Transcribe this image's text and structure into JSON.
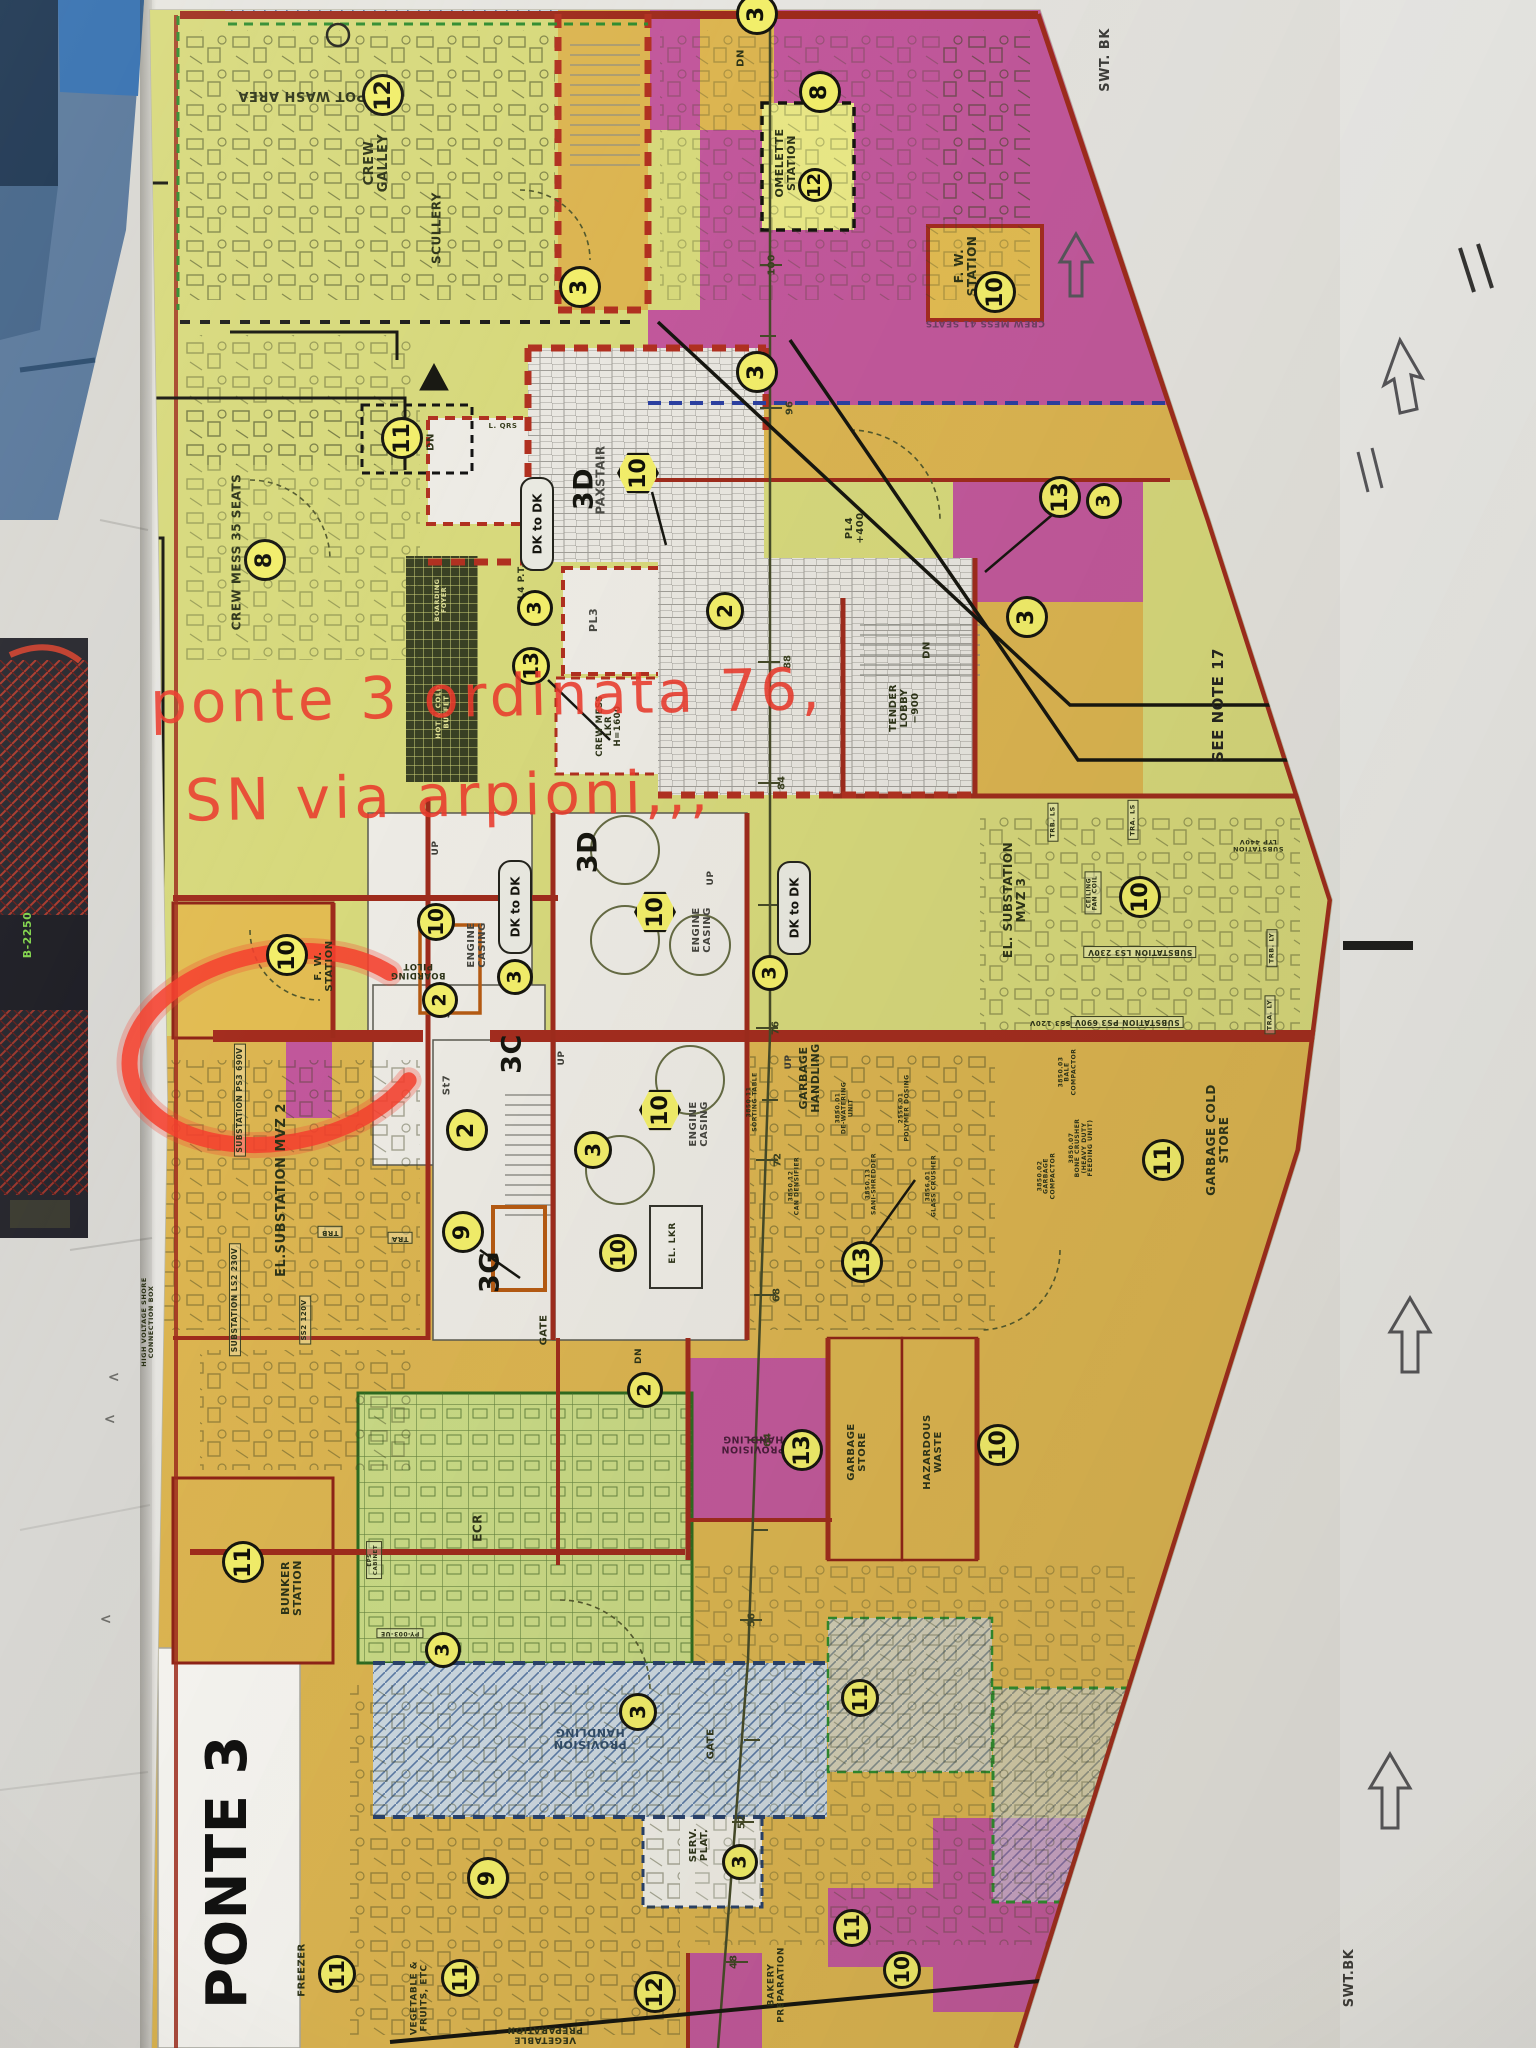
{
  "annotation": {
    "line1": "ponte 3 ordinata 76,",
    "line2": "SN  via arpioni,,,",
    "color": "#ea3a2c"
  },
  "colors": {
    "plan_yellow_green": "#d7d97c",
    "plan_gold": "#dcb551",
    "plan_magenta": "#c2589c",
    "wall_red": "#a32c1e",
    "badge_yellow": "#f2ee6a",
    "marker_red": "#f4402e",
    "hatch_blue": "#5577aa"
  },
  "plan": {
    "dk_pill_label": "DK to DK",
    "deck_title": "PONTE 3",
    "labels": [
      {
        "id": "pot-wash-area-label",
        "t": "POT WASH AREA",
        "x": 302,
        "y": 95,
        "rot": 180,
        "fs": 13
      },
      {
        "id": "crew-galley-label",
        "t": "CREW\nGALLEY",
        "x": 377,
        "y": 163,
        "rot": -90,
        "fs": 13
      },
      {
        "id": "scullery-label",
        "t": "SCULLERY",
        "x": 437,
        "y": 228,
        "rot": -90,
        "fs": 12
      },
      {
        "id": "omelette-station-label",
        "t": "OMELETTE\nSTATION",
        "x": 786,
        "y": 163,
        "rot": -90,
        "fs": 11
      },
      {
        "id": "fw-station-1-label",
        "t": "F. W.\nSTATION",
        "x": 966,
        "y": 266,
        "rot": -90,
        "fs": 12
      },
      {
        "id": "crew-mess-41-label",
        "t": "CREW MESS 41 SEATS",
        "x": 985,
        "y": 322,
        "rot": 180,
        "fs": 9,
        "c": "#6e3d63"
      },
      {
        "id": "dn-top-label",
        "t": "DN",
        "x": 742,
        "y": 58,
        "rot": -90,
        "fs": 10
      },
      {
        "id": "lqrs-label",
        "t": "L. QRS",
        "x": 503,
        "y": 427,
        "rot": 0,
        "fs": 7,
        "c": "#3a4020"
      },
      {
        "id": "dn-11-label",
        "t": "DN",
        "x": 432,
        "y": 442,
        "rot": -90,
        "fs": 10
      },
      {
        "id": "crew-mess-35-label",
        "t": "CREW MESS  35 SEATS",
        "x": 237,
        "y": 552,
        "rot": -90,
        "fs": 12
      },
      {
        "id": "hot-cold-buffet-label",
        "t": "HOT & COLD\nBUFFET",
        "x": 443,
        "y": 712,
        "rot": -90,
        "fs": 7,
        "c": "#e2e294"
      },
      {
        "id": "boarding-foyer-label",
        "t": "BOARDING\nFOYER",
        "x": 441,
        "y": 600,
        "rot": -90,
        "fs": 6.5,
        "c": "#dfe09a"
      },
      {
        "id": "paxstair-label",
        "t": "PAXSTAIR",
        "x": 601,
        "y": 480,
        "rot": -90,
        "fs": 12,
        "c": "#4a4a44"
      },
      {
        "id": "pl3-label",
        "t": "PL3",
        "x": 594,
        "y": 620,
        "rot": -90,
        "fs": 11,
        "c": "#4a4a44"
      },
      {
        "id": "pl4-pt-label",
        "t": "PL4 P.T.",
        "x": 523,
        "y": 585,
        "rot": -90,
        "fs": 9
      },
      {
        "id": "crew-mess-lkr-label",
        "t": "CREW MESS\nLKR\nH=1600",
        "x": 610,
        "y": 726,
        "rot": -90,
        "fs": 8.5
      },
      {
        "id": "pl4-400-label",
        "t": "PL4\n+400",
        "x": 856,
        "y": 528,
        "rot": -90,
        "fs": 10
      },
      {
        "id": "tender-lobby-label",
        "t": "TENDER\nLOBBY\n−900",
        "x": 905,
        "y": 708,
        "rot": -90,
        "fs": 10
      },
      {
        "id": "dn-tender-label",
        "t": "DN",
        "x": 928,
        "y": 650,
        "rot": -90,
        "fs": 10
      },
      {
        "id": "see-note-17-label",
        "t": "SEE NOTE 17",
        "x": 1218,
        "y": 705,
        "rot": -90,
        "fs": 15,
        "c": "#23231f",
        "w": 700
      },
      {
        "id": "swt-bk-top-label",
        "t": "SWT. BK",
        "x": 1106,
        "y": 60,
        "rot": -90,
        "fs": 13,
        "c": "#3c3c3a"
      },
      {
        "id": "swt-bk-bottom-label",
        "t": "SWT.BK",
        "x": 1350,
        "y": 1978,
        "rot": -90,
        "fs": 13,
        "c": "#3c3c3a"
      },
      {
        "id": "boarding-pilot-label",
        "t": "BOARDING\nPILOT",
        "x": 418,
        "y": 970,
        "rot": 180,
        "fs": 8.5
      },
      {
        "id": "fw-station-2-label",
        "t": "F. W.\nSTATION",
        "x": 325,
        "y": 966,
        "rot": -90,
        "fs": 10
      },
      {
        "id": "engine-casing-1-label",
        "t": "ENGINE\nCASING",
        "x": 478,
        "y": 945,
        "rot": -90,
        "fs": 10,
        "c": "#45453f"
      },
      {
        "id": "engine-casing-2-label",
        "t": "ENGINE\nCASING",
        "x": 703,
        "y": 930,
        "rot": -90,
        "fs": 10,
        "c": "#45453f"
      },
      {
        "id": "engine-casing-3-label",
        "t": "ENGINE\nCASING",
        "x": 700,
        "y": 1124,
        "rot": -90,
        "fs": 10,
        "c": "#45453f"
      },
      {
        "id": "st6-label",
        "t": "St6",
        "x": 448,
        "y": 1008,
        "rot": -90,
        "fs": 10,
        "c": "#45453f"
      },
      {
        "id": "st7-label",
        "t": "St7",
        "x": 448,
        "y": 1085,
        "rot": -90,
        "fs": 10,
        "c": "#45453f"
      },
      {
        "id": "up-1-label",
        "t": "UP",
        "x": 437,
        "y": 848,
        "rot": -90,
        "fs": 9,
        "c": "#3c3c36"
      },
      {
        "id": "up-2-label",
        "t": "UP",
        "x": 712,
        "y": 878,
        "rot": -90,
        "fs": 9,
        "c": "#3c3c36"
      },
      {
        "id": "up-3-label",
        "t": "UP",
        "x": 563,
        "y": 1058,
        "rot": -90,
        "fs": 9,
        "c": "#3c3c36"
      },
      {
        "id": "up-4-label",
        "t": "UP",
        "x": 790,
        "y": 1062,
        "rot": -90,
        "fs": 9,
        "c": "#3c3c36"
      },
      {
        "id": "el-substation-mvz2-label",
        "t": "EL.SUBSTATION MVZ 2",
        "x": 282,
        "y": 1190,
        "rot": -90,
        "fs": 13
      },
      {
        "id": "substation-ps3-690v-1-label",
        "t": "SUBSTATION PS3 690V",
        "x": 240,
        "y": 1100,
        "rot": -90,
        "fs": 7.5,
        "box": 1
      },
      {
        "id": "substation-ls2-230v-label",
        "t": "SUBSTATION LS2 230V",
        "x": 235,
        "y": 1300,
        "rot": -90,
        "fs": 7.5,
        "box": 1
      },
      {
        "id": "ss2-120v-label",
        "t": "SS2 120V",
        "x": 305,
        "y": 1320,
        "rot": -90,
        "fs": 7,
        "box": 1
      },
      {
        "id": "hv-shore-connection-label",
        "t": "HIGH VOLTAGE SHORE\nCONNECTION BOX",
        "x": 148,
        "y": 1322,
        "rot": -90,
        "fs": 6.5
      },
      {
        "id": "trb-1-label",
        "t": "TRB",
        "x": 330,
        "y": 1232,
        "rot": 180,
        "fs": 7,
        "box": 1
      },
      {
        "id": "tra-1-label",
        "t": "TRA",
        "x": 400,
        "y": 1238,
        "rot": 180,
        "fs": 7,
        "box": 1
      },
      {
        "id": "el-substation-mvz3-label",
        "t": "EL. SUBSTATION\nMVZ 3",
        "x": 1015,
        "y": 900,
        "rot": -90,
        "fs": 12
      },
      {
        "id": "substation-ls3-230v-label",
        "t": "SUBSTATION LS3 230V",
        "x": 1140,
        "y": 952,
        "rot": 180,
        "fs": 7.5,
        "box": 1
      },
      {
        "id": "substation-ps3-690v-2-label",
        "t": "SUBSTATION PS3 690V",
        "x": 1127,
        "y": 1022,
        "rot": 180,
        "fs": 7.5,
        "box": 1
      },
      {
        "id": "ss3-120v-label",
        "t": "SS3 120V",
        "x": 1050,
        "y": 1022,
        "rot": 180,
        "fs": 7
      },
      {
        "id": "trb-ls-label",
        "t": "TRB. LS",
        "x": 1053,
        "y": 822,
        "rot": -90,
        "fs": 6.5,
        "box": 1
      },
      {
        "id": "tra-ls-label",
        "t": "TRA. LS",
        "x": 1133,
        "y": 820,
        "rot": -90,
        "fs": 6.5,
        "box": 1
      },
      {
        "id": "trb-ly-label",
        "t": "TRB. LY",
        "x": 1272,
        "y": 948,
        "rot": -90,
        "fs": 6.5,
        "box": 1
      },
      {
        "id": "tra-ly-label",
        "t": "TRA. LY",
        "x": 1270,
        "y": 1015,
        "rot": -90,
        "fs": 6.5,
        "box": 1
      },
      {
        "id": "substation-lyp-label",
        "t": "SUBSTATION\nLYP 440V",
        "x": 1258,
        "y": 845,
        "rot": 180,
        "fs": 6.5
      },
      {
        "id": "ceiling-fan-coil-label",
        "t": "CEILING\nFAN COIL",
        "x": 1093,
        "y": 893,
        "rot": -90,
        "fs": 6,
        "box": 1
      },
      {
        "id": "garbage-cold-store-label",
        "t": "GARBAGE COLD\nSTORE",
        "x": 1218,
        "y": 1140,
        "rot": -90,
        "fs": 12
      },
      {
        "id": "garbage-handling-label",
        "t": "GARBAGE\nHANDLING",
        "x": 810,
        "y": 1078,
        "rot": -90,
        "fs": 11
      },
      {
        "id": "sorting-table-label",
        "t": "3850.11\nSORTING TABLE",
        "x": 753,
        "y": 1102,
        "rot": -90,
        "fs": 6
      },
      {
        "id": "dewatering-unit-label",
        "t": "3850.01\nDE-WATERING\nUNIT",
        "x": 845,
        "y": 1108,
        "rot": -90,
        "fs": 6
      },
      {
        "id": "polymer-dosing-label",
        "t": "2556.01\nPOLYMER DOSING",
        "x": 905,
        "y": 1108,
        "rot": -90,
        "fs": 6
      },
      {
        "id": "sani-shredder-label",
        "t": "3850.13\nSANI-SHREDDER",
        "x": 872,
        "y": 1184,
        "rot": -90,
        "fs": 6
      },
      {
        "id": "glass-crusher-label",
        "t": "3856.01\nGLASS CRUSHER",
        "x": 932,
        "y": 1186,
        "rot": -90,
        "fs": 6
      },
      {
        "id": "can-densifier-label",
        "t": "3850.12\nCAN DENSIFIER",
        "x": 795,
        "y": 1186,
        "rot": -90,
        "fs": 6
      },
      {
        "id": "garbage-compactor-label",
        "t": "3850.02\nGARBAGE\nCOMPACTOR",
        "x": 1047,
        "y": 1176,
        "rot": -90,
        "fs": 6
      },
      {
        "id": "bone-crusher-label",
        "t": "3850.07\nBONE CRUSHER\n(HEAVY DUTY\nFEEDING UNIT)",
        "x": 1082,
        "y": 1148,
        "rot": -90,
        "fs": 6
      },
      {
        "id": "bale-compactor-label",
        "t": "3850.03\nBALE\nCOMPACTOR",
        "x": 1068,
        "y": 1072,
        "rot": -90,
        "fs": 6
      },
      {
        "id": "zone-3c-label",
        "t": "3C",
        "x": 512,
        "y": 1054,
        "rot": -90,
        "fs": 27,
        "w": 700,
        "c": "#15150f"
      },
      {
        "id": "zone-3d-1-label",
        "t": "3D",
        "x": 584,
        "y": 489,
        "rot": -90,
        "fs": 27,
        "w": 700,
        "c": "#15150f"
      },
      {
        "id": "zone-3d-2-label",
        "t": "3D",
        "x": 588,
        "y": 852,
        "rot": -90,
        "fs": 27,
        "w": 700,
        "c": "#15150f"
      },
      {
        "id": "zone-3g-label",
        "t": "3G",
        "x": 490,
        "y": 1272,
        "rot": -90,
        "fs": 27,
        "w": 700,
        "c": "#15150f"
      },
      {
        "id": "bunker-station-label",
        "t": "BUNKER\nSTATION",
        "x": 292,
        "y": 1588,
        "rot": -90,
        "fs": 11
      },
      {
        "id": "ecr-label",
        "t": "ECR",
        "x": 478,
        "y": 1528,
        "rot": -90,
        "fs": 12
      },
      {
        "id": "py-003-ue-label",
        "t": "PY-003-UE",
        "x": 400,
        "y": 1633,
        "rot": 180,
        "fs": 6,
        "box": 1
      },
      {
        "id": "eps-cabinet-label",
        "t": "EPS\nCABINET",
        "x": 374,
        "y": 1560,
        "rot": -90,
        "fs": 5.5,
        "box": 1
      },
      {
        "id": "provision-handling-1-label",
        "t": "PROVISION\nHANDLING",
        "x": 590,
        "y": 1738,
        "rot": 180,
        "fs": 11,
        "c": "#2f4b68"
      },
      {
        "id": "provision-handling-2-label",
        "t": "PROVISION\nHANDLING",
        "x": 753,
        "y": 1443,
        "rot": 180,
        "fs": 9.5,
        "c": "#4a1c3c"
      },
      {
        "id": "garbage-store-label",
        "t": "GARBAGE\nSTORE",
        "x": 858,
        "y": 1452,
        "rot": -90,
        "fs": 10
      },
      {
        "id": "hazardous-waste-label",
        "t": "HAZARDOUS\nWASTE",
        "x": 934,
        "y": 1452,
        "rot": -90,
        "fs": 10
      },
      {
        "id": "el-lkr-label",
        "t": "EL. LKR",
        "x": 674,
        "y": 1243,
        "rot": -90,
        "fs": 9
      },
      {
        "id": "gate-1-label",
        "t": "GATE",
        "x": 545,
        "y": 1330,
        "rot": -90,
        "fs": 10
      },
      {
        "id": "gate-2-label",
        "t": "GATE",
        "x": 712,
        "y": 1744,
        "rot": -90,
        "fs": 10
      },
      {
        "id": "dn-spine-label",
        "t": "DN",
        "x": 640,
        "y": 1356,
        "rot": -90,
        "fs": 9
      },
      {
        "id": "freezer-label",
        "t": "FREEZER",
        "x": 303,
        "y": 1970,
        "rot": -90,
        "fs": 10
      },
      {
        "id": "veg-fruits-label",
        "t": "VEGETABLE &\nFRUITS, ETC",
        "x": 420,
        "y": 1998,
        "rot": -90,
        "fs": 9
      },
      {
        "id": "veg-preparation-label",
        "t": "VEGETABLE\nPREPARATION",
        "x": 545,
        "y": 2034,
        "rot": 180,
        "fs": 9
      },
      {
        "id": "serv-plat-label",
        "t": "SERV.\nPLAT.",
        "x": 700,
        "y": 1845,
        "rot": -90,
        "fs": 10
      },
      {
        "id": "bakery-preparation-label",
        "t": "BAKERY\nPREPARATION",
        "x": 777,
        "y": 1985,
        "rot": -90,
        "fs": 9
      },
      {
        "id": "ponte-3-label",
        "t": "PONTE 3",
        "x": 228,
        "y": 1872,
        "rot": -90,
        "fs": 56,
        "w": 800,
        "c": "#101010"
      },
      {
        "id": "b-2250-label",
        "t": "B-2250",
        "x": 28,
        "y": 935,
        "rot": -90,
        "fs": 11,
        "c": "#7fd24a"
      },
      {
        "id": "chevron-1-label",
        "t": "<",
        "x": 114,
        "y": 1378,
        "rot": 0,
        "fs": 14,
        "c": "#6e6e6a"
      },
      {
        "id": "chevron-2-label",
        "t": "<",
        "x": 110,
        "y": 1420,
        "rot": 0,
        "fs": 14,
        "c": "#6e6e6a"
      },
      {
        "id": "chevron-3-label",
        "t": "<",
        "x": 106,
        "y": 1620,
        "rot": 0,
        "fs": 14,
        "c": "#6e6e6a"
      }
    ],
    "frames": [
      {
        "t": "100",
        "x": 772,
        "y": 265
      },
      {
        "t": "96",
        "x": 790,
        "y": 408
      },
      {
        "t": "88",
        "x": 788,
        "y": 662
      },
      {
        "t": "84",
        "x": 782,
        "y": 783
      },
      {
        "t": "76",
        "x": 776,
        "y": 1028
      },
      {
        "t": "72",
        "x": 778,
        "y": 1160
      },
      {
        "t": "68",
        "x": 777,
        "y": 1295
      },
      {
        "t": "64",
        "x": 768,
        "y": 1440
      },
      {
        "t": "56",
        "x": 752,
        "y": 1620
      },
      {
        "t": "52",
        "x": 742,
        "y": 1822
      },
      {
        "t": "48",
        "x": 734,
        "y": 1962
      }
    ],
    "badges": [
      {
        "v": "12",
        "x": 383,
        "y": 95
      },
      {
        "v": "8",
        "x": 820,
        "y": 92
      },
      {
        "v": "3",
        "x": 757,
        "y": 14
      },
      {
        "v": "12",
        "x": 815,
        "y": 185,
        "r": 17
      },
      {
        "v": "10",
        "x": 995,
        "y": 292
      },
      {
        "v": "3",
        "x": 580,
        "y": 287
      },
      {
        "v": "11",
        "x": 402,
        "y": 438
      },
      {
        "v": "3",
        "x": 757,
        "y": 372
      },
      {
        "v": "13",
        "x": 1060,
        "y": 497
      },
      {
        "v": "3",
        "x": 1104,
        "y": 501,
        "r": 18
      },
      {
        "v": "8",
        "x": 265,
        "y": 560
      },
      {
        "v": "3",
        "x": 535,
        "y": 608,
        "r": 18
      },
      {
        "v": "13",
        "x": 531,
        "y": 666,
        "r": 19
      },
      {
        "v": "3",
        "x": 1027,
        "y": 617
      },
      {
        "v": "2",
        "x": 725,
        "y": 611,
        "r": 19
      },
      {
        "v": "10",
        "x": 638,
        "y": 473,
        "shape": "hex"
      },
      {
        "v": "10",
        "x": 287,
        "y": 955
      },
      {
        "v": "2",
        "x": 440,
        "y": 1000,
        "r": 18
      },
      {
        "v": "3",
        "x": 515,
        "y": 977,
        "r": 18
      },
      {
        "v": "3",
        "x": 770,
        "y": 973,
        "r": 18
      },
      {
        "v": "10",
        "x": 436,
        "y": 922,
        "r": 19
      },
      {
        "v": "10",
        "x": 655,
        "y": 912,
        "shape": "hex"
      },
      {
        "v": "10",
        "x": 660,
        "y": 1110,
        "shape": "hex"
      },
      {
        "v": "10",
        "x": 1140,
        "y": 897
      },
      {
        "v": "2",
        "x": 467,
        "y": 1130
      },
      {
        "v": "9",
        "x": 463,
        "y": 1232
      },
      {
        "v": "11",
        "x": 1163,
        "y": 1160
      },
      {
        "v": "13",
        "x": 862,
        "y": 1262
      },
      {
        "v": "11",
        "x": 243,
        "y": 1562
      },
      {
        "v": "3",
        "x": 593,
        "y": 1150,
        "r": 19
      },
      {
        "v": "10",
        "x": 618,
        "y": 1253,
        "r": 19
      },
      {
        "v": "2",
        "x": 645,
        "y": 1390,
        "r": 18
      },
      {
        "v": "13",
        "x": 802,
        "y": 1450
      },
      {
        "v": "10",
        "x": 998,
        "y": 1445
      },
      {
        "v": "11",
        "x": 337,
        "y": 1974,
        "r": 19
      },
      {
        "v": "11",
        "x": 460,
        "y": 1978,
        "r": 19
      },
      {
        "v": "3",
        "x": 740,
        "y": 1862,
        "r": 18
      },
      {
        "v": "3",
        "x": 638,
        "y": 1712,
        "r": 19
      },
      {
        "v": "3",
        "x": 443,
        "y": 1650,
        "r": 18
      },
      {
        "v": "9",
        "x": 488,
        "y": 1878
      },
      {
        "v": "12",
        "x": 655,
        "y": 1992
      },
      {
        "v": "11",
        "x": 852,
        "y": 1928,
        "r": 19
      },
      {
        "v": "11",
        "x": 860,
        "y": 1698,
        "r": 19
      },
      {
        "v": "10",
        "x": 902,
        "y": 1970,
        "r": 19
      }
    ],
    "pills": [
      {
        "x": 535,
        "y": 522
      },
      {
        "x": 513,
        "y": 905
      },
      {
        "x": 792,
        "y": 906
      }
    ]
  }
}
